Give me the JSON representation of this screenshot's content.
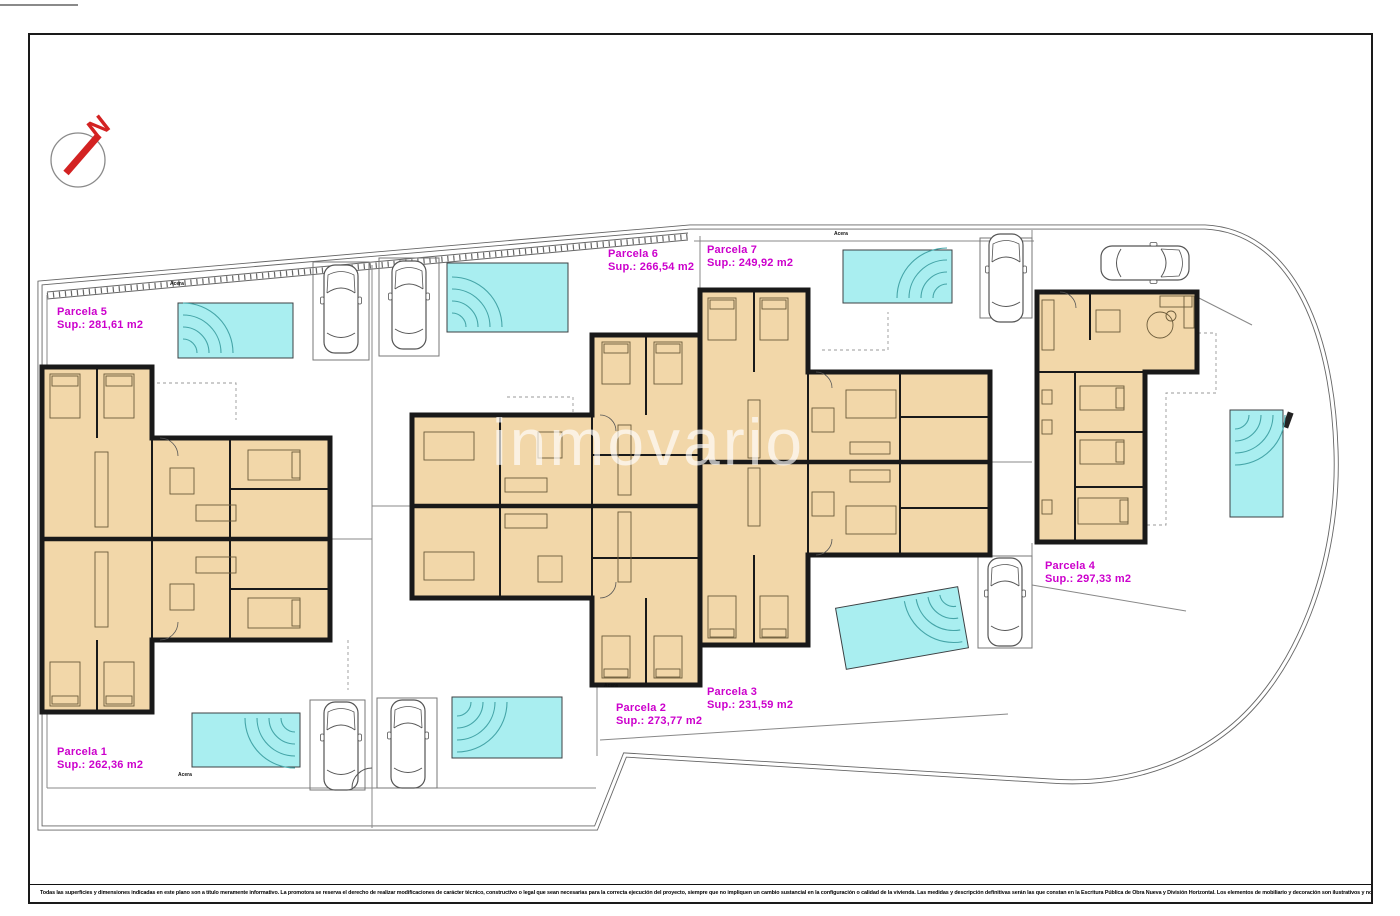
{
  "north": {
    "label": "N"
  },
  "watermark": "inmovario",
  "parcels": [
    {
      "name": "Parcela 1",
      "area": "Sup.: 262,36 m2"
    },
    {
      "name": "Parcela 2",
      "area": "Sup.: 273,77 m2"
    },
    {
      "name": "Parcela 3",
      "area": "Sup.: 231,59 m2"
    },
    {
      "name": "Parcela 4",
      "area": "Sup.: 297,33 m2"
    },
    {
      "name": "Parcela 5",
      "area": "Sup.: 281,61 m2"
    },
    {
      "name": "Parcela 6",
      "area": "Sup.: 266,54 m2"
    },
    {
      "name": "Parcela 7",
      "area": "Sup.: 249,92 m2"
    }
  ],
  "small_label": "Acera",
  "disclaimer": "Todas las superficies y dimensiones indicadas en este plano son a título meramente informativo. La promotora se reserva el derecho de realizar modificaciones de carácter técnico, constructivo o legal que sean necesarias para la correcta ejecución del proyecto, siempre que no impliquen un cambio sustancial en la configuración o calidad de la vivienda. Las medidas y descripción definitivas serán las que constan en la Escritura Pública de Obra Nueva y División Horizontal. Los elementos de mobiliario y decoración son ilustrativos y no serán incluidos.",
  "colors": {
    "parcel_label": "#cc00cc",
    "pool_fill": "#a9eef0",
    "room_fill": "#f2d7a9",
    "wall": "#191919",
    "north_arrow": "#d32222"
  }
}
